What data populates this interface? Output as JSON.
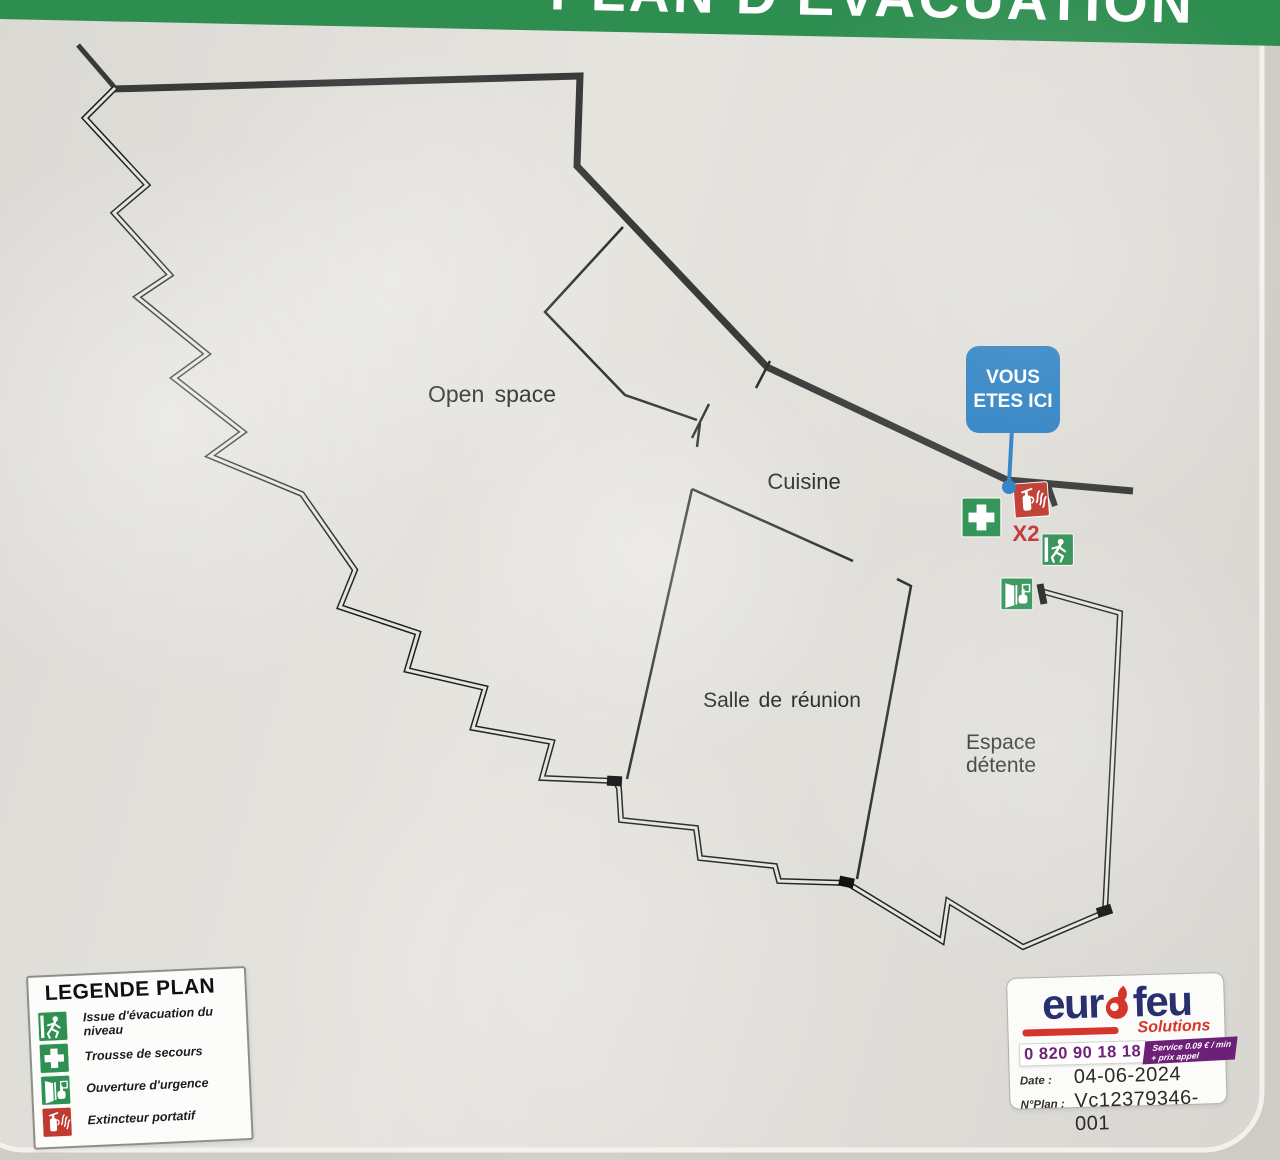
{
  "banner": {
    "title": "PLAN D'ÉVACUATION",
    "bg_color": "#2e8e50",
    "text_color": "#ffffff"
  },
  "rooms": {
    "open_space": {
      "label": "Open space"
    },
    "cuisine": {
      "label": "Cuisine"
    },
    "salle_de_reunion": {
      "label": "Salle de réunion"
    },
    "espace_detente": {
      "line1": "Espace",
      "line2": "détente"
    }
  },
  "you_are_here": {
    "line1": "VOUS",
    "line2": "ETES ICI",
    "bg_color": "#2b80c2"
  },
  "map_symbols": {
    "extinguisher_count_label": "X2"
  },
  "legend": {
    "title": "LEGENDE PLAN",
    "items": [
      {
        "icon": "exit-running-man-icon",
        "label": "Issue d'évacuation du niveau"
      },
      {
        "icon": "first-aid-cross-icon",
        "label": "Trousse de secours"
      },
      {
        "icon": "emergency-opening-icon",
        "label": "Ouverture d'urgence"
      },
      {
        "icon": "fire-extinguisher-icon",
        "label": "Extincteur portatif"
      }
    ]
  },
  "vendor": {
    "brand_left": "eur",
    "brand_right": "feu",
    "tagline": "Solutions",
    "phone": "0 820 90 18 18",
    "service_line1": "Service 0.09 € / min",
    "service_line2": "+ prix appel",
    "date_label": "Date :",
    "date_value": "04-06-2024",
    "plan_label": "N°Plan :",
    "plan_value": "Vc12379346-001"
  },
  "colors": {
    "banner_green": "#2e8e50",
    "icon_green": "#2f9053",
    "icon_red": "#bf3a2f",
    "badge_blue": "#2b80c2",
    "brand_navy": "#283070",
    "brand_red": "#d6352b",
    "phone_purple": "#702279",
    "wall_dark": "#3a3a3a"
  }
}
